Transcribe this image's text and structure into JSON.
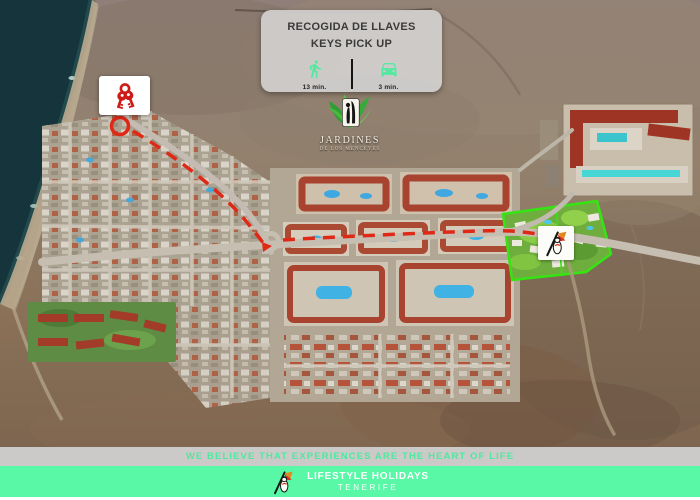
{
  "info_card": {
    "title_es": "RECOGIDA DE LLAVES",
    "title_en": "KEYS PICK UP",
    "walk_time": "13 min.",
    "drive_time": "3 min.",
    "walk_icon": "walking-person-icon",
    "drive_icon": "car-icon"
  },
  "map": {
    "resort_logo": {
      "title": "JARDINES",
      "subtitle": "DE LOS MENCEYES"
    },
    "keys_marker_icon": "keys-icon",
    "route_style": "red-dashed",
    "resort_chip_icon": "lifestyle-figure-icon"
  },
  "banner": {
    "text": "WE BELIEVE THAT EXPERIENCES ARE THE HEART OF LIFE"
  },
  "footer": {
    "brand": "LIFESTYLE HOLIDAYS",
    "location": "TENERIFE",
    "icon": "lifestyle-figure-icon"
  },
  "colors": {
    "accent_green": "#52E9A0",
    "footer_green": "#58F8A7",
    "banner_bg": "#CBCAC8",
    "banner_text": "#4FE89E",
    "route_red": "#E02817",
    "resort_outline_green": "#35E513",
    "card_bg": "#D0CECC",
    "card_text": "#3A3A3A",
    "sea": "#16343C"
  }
}
